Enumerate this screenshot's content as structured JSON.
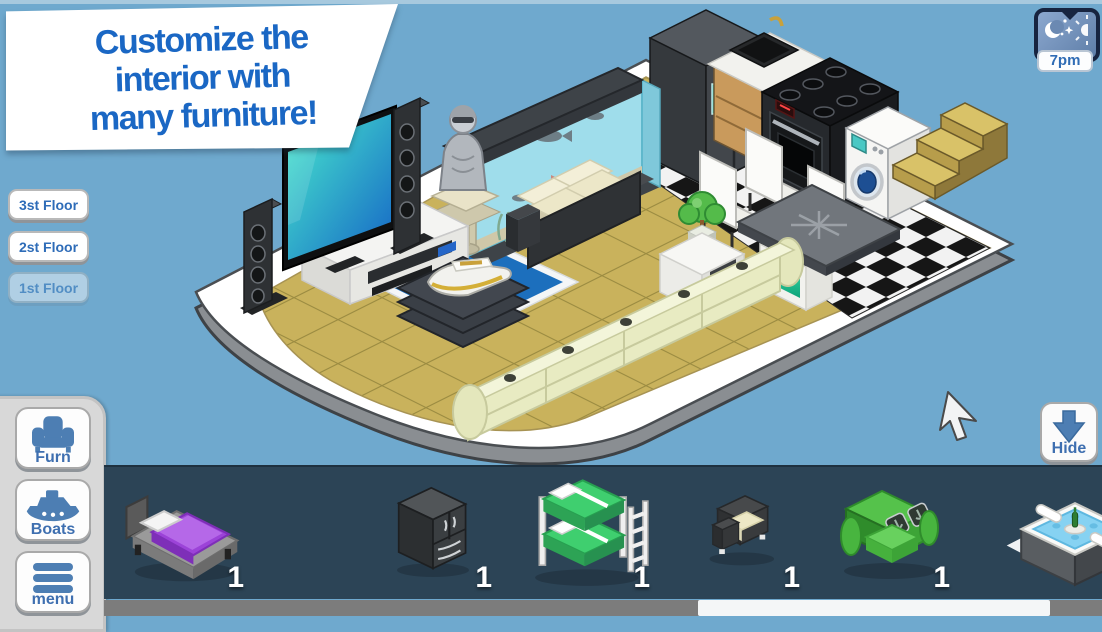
{
  "banner": {
    "line1": "Customize the",
    "line2": "interior with",
    "line3": "many furniture!"
  },
  "time_button": {
    "label": "7pm",
    "icon": "moon-stars-sun-icon"
  },
  "floor_buttons": {
    "floor3": "3st Floor",
    "floor2": "2st Floor",
    "floor1": "1st Floor"
  },
  "dock": {
    "furn_label": "Furn",
    "boats_label": "Boats",
    "menu_label": "menu",
    "icons": [
      "armchair-icon",
      "boat-icon",
      "hamburger-icon"
    ]
  },
  "hide_button": {
    "label": "Hide",
    "icon": "arrow-down-icon"
  },
  "inventory": {
    "items": [
      {
        "name": "bed",
        "count": "1"
      },
      {
        "name": "wardrobe",
        "count": "1"
      },
      {
        "name": "bunk-bed",
        "count": "1"
      },
      {
        "name": "armchair",
        "count": "1"
      },
      {
        "name": "green-sofa",
        "count": "1"
      },
      {
        "name": "hot-tub",
        "count": "1"
      }
    ]
  },
  "scene": {
    "description": "isometric houseboat interior",
    "furniture": [
      "tv",
      "tower-speakers",
      "media-console",
      "statue",
      "aquarium",
      "fridge",
      "sink-cabinet",
      "stove",
      "washing-machine",
      "stairs",
      "dining-table",
      "dining-chairs",
      "gray-loveseat",
      "side-table-bonsai",
      "coffee-table-yacht",
      "long-cream-sofa"
    ],
    "floors": [
      "tan-tiles",
      "checkered-kitchen-tiles",
      "blue-rug"
    ]
  },
  "colors": {
    "sky": "#6FA9CE",
    "banner_text": "#1A67C4",
    "button_blue": "#3E6FB0",
    "bar_navy": "#2C4456",
    "tile_tan": "#C9B25C",
    "rug_blue": "#1C6FBD",
    "accent_teal": "#35E8B0"
  }
}
